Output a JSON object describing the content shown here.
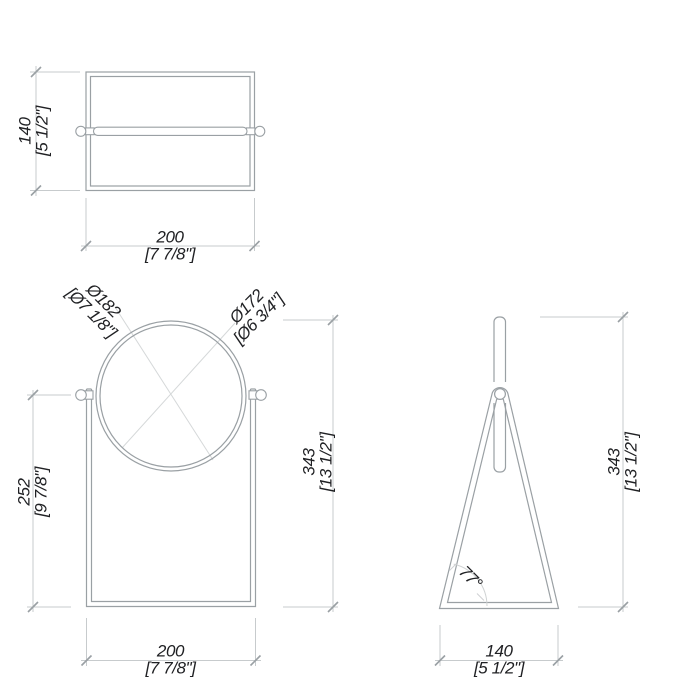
{
  "views": {
    "top": {
      "height": {
        "mm": "140",
        "in": "[5 1/2\"]"
      },
      "width": {
        "mm": "200",
        "in": "[7 7/8\"]"
      }
    },
    "front": {
      "outer_diameter": {
        "mm": "Ø182",
        "in": "[Ø7 1/8\"]"
      },
      "inner_diameter": {
        "mm": "Ø172",
        "in": "[Ø6 3/4\"]"
      },
      "pivot_height": {
        "mm": "252",
        "in": "[9 7/8\"]"
      },
      "total_height": {
        "mm": "343",
        "in": "[13 1/2\"]"
      },
      "width": {
        "mm": "200",
        "in": "[7 7/8\"]"
      }
    },
    "side": {
      "total_height": {
        "mm": "343",
        "in": "[13 1/2\"]"
      },
      "base_depth": {
        "mm": "140",
        "in": "[5 1/2\"]"
      },
      "leg_angle": "77°"
    }
  },
  "colors": {
    "object_line": "#9aa0a4",
    "dimension_line": "#c7cbcd",
    "leader_line": "#d5d8d9",
    "text": "#202124"
  }
}
